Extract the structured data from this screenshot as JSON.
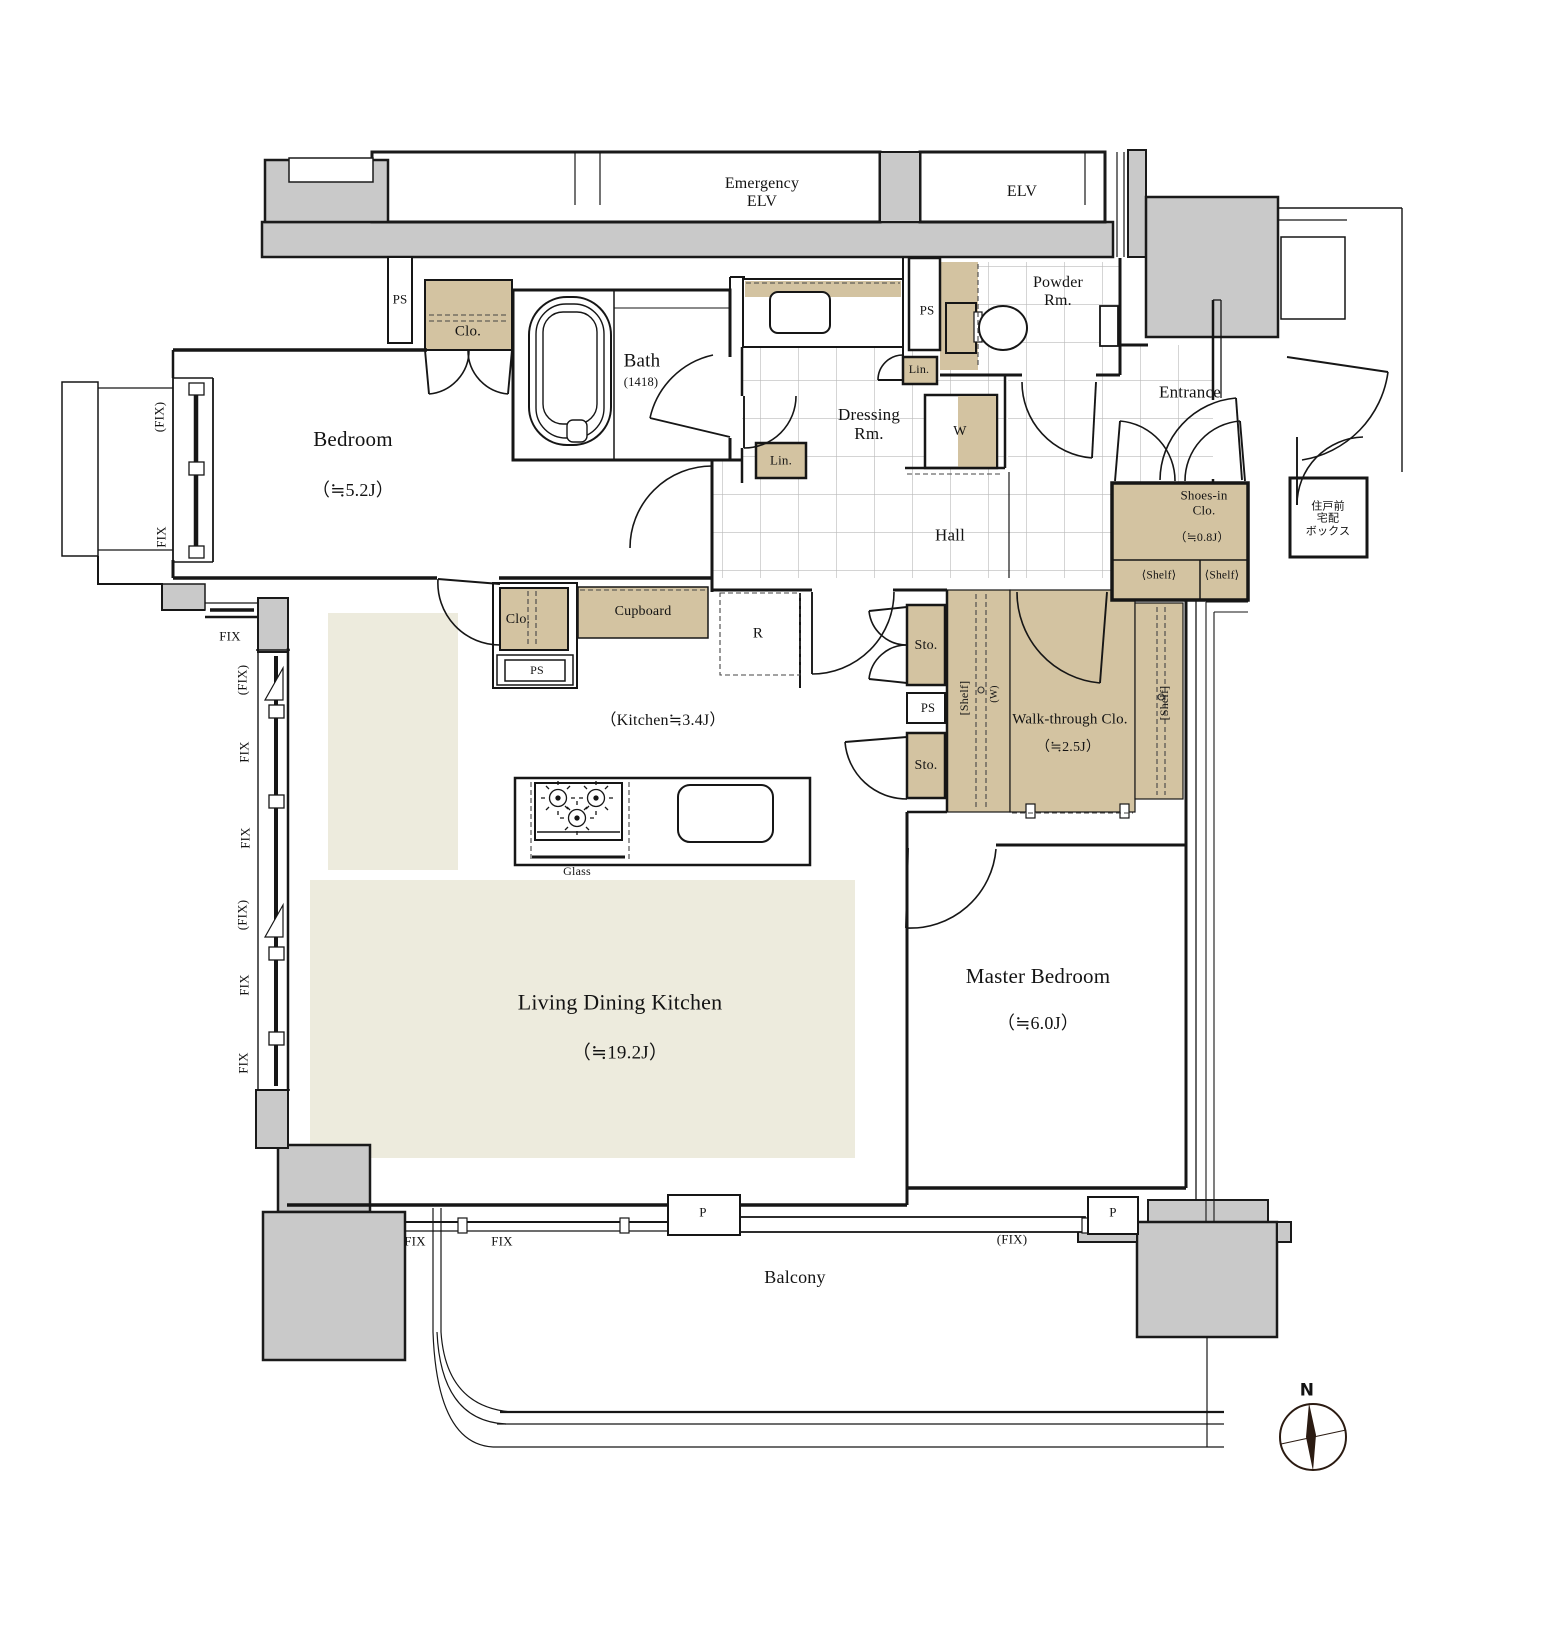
{
  "plan_title": "apartment unit floor plan",
  "colors": {
    "wall_gray": "#c9c9c9",
    "wood_tan": "#d3c3a1",
    "floor_beige": "#edebdd",
    "tile_line": "#b9b9b9",
    "line_black": "#161616",
    "compass_ink": "#2b1b12"
  },
  "labels": {
    "emergency_elv": "Emergency\nELV",
    "elv": "ELV",
    "ps": "PS",
    "clo": "Clo.",
    "lin": "Lin.",
    "sto": "Sto.",
    "w": "W",
    "w_paren": "(W)",
    "r": "R",
    "p": "P",
    "fix": "FIX",
    "fix_paren": "(FIX)",
    "glass": "Glass",
    "cupboard": "Cupboard",
    "shelf_angled": "⟨Shelf⟩",
    "shelf_bracket": "[Shelf]",
    "north": "N"
  },
  "rooms": {
    "bedroom": {
      "name": "Bedroom",
      "size": "（≒5.2J）"
    },
    "bath": {
      "name": "Bath",
      "size": "(1418)"
    },
    "powder": {
      "name": "Powder\nRm."
    },
    "dressing": {
      "name": "Dressing\nRm."
    },
    "entrance": {
      "name": "Entrance"
    },
    "hall": {
      "name": "Hall"
    },
    "shoes_in_closet": {
      "name": "Shoes-in\nClo.",
      "size": "（≒0.8J）"
    },
    "delivery_box": {
      "name": "住戸前\n宅配\nボックス"
    },
    "kitchen": {
      "size": "（Kitchen≒3.4J）"
    },
    "walk_through_closet": {
      "name": "Walk-through Clo.",
      "size": "（≒2.5J）"
    },
    "ldk": {
      "name": "Living Dining Kitchen",
      "size": "（≒19.2J）"
    },
    "master_bedroom": {
      "name": "Master Bedroom",
      "size": "（≒6.0J）"
    },
    "balcony": {
      "name": "Balcony"
    }
  }
}
